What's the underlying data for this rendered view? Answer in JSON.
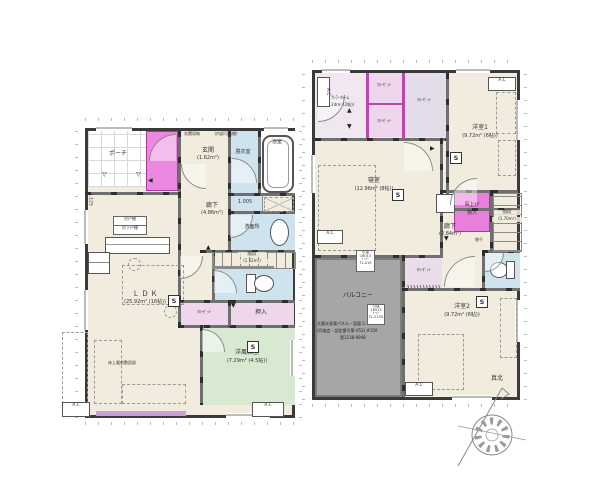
{
  "meta": {
    "type": "house-floor-plan",
    "floors": 2
  },
  "glyphs": {
    "tri_up": "▲",
    "tri_down": "▼",
    "tri_open": "▽",
    "tri_left": "◀",
    "tri_right": "▶"
  },
  "marks": {
    "smoke_detector": "S",
    "ac_unit": "A.C"
  },
  "colors": {
    "wet": "#cfe3ef",
    "tatami": "#d8e9d2",
    "pink": "#eed7ec",
    "magenta": "#ec87df",
    "balcony": "#a6a6a6",
    "lavender": "#e4dcea",
    "floor": "#f1ecdd",
    "deck": "#c9a0d8"
  },
  "floor1": {
    "porch": "ポーチ",
    "entrance_name": "玄関",
    "entrance_area": "(1.62m²)",
    "entrance_storage": "玄関収納",
    "entrance_storage_note": "(内部可動棚)",
    "bath": "浴室",
    "dressing": "脱衣室",
    "washroom": "洗面所",
    "dim_washroom": "1.005",
    "dim_left": "1.125",
    "hall_name": "廊下",
    "hall_area": "(4.86m²)",
    "stairs_name": "階段",
    "stairs_area": "(1.62m²)",
    "closet": "ｸﾛｰｾﾞｯﾄ",
    "oshiire": "押入",
    "washitsu_name": "洋風和室",
    "washitsu_area": "(7.29m² (4.5帖))",
    "ldk_name": "ＬＤＫ",
    "ldk_area": "(25.92m² (16帖))",
    "kitchen_length": "L=2550",
    "cupboard_tag_1": "吊戸棚",
    "cupboard_tag_2": "吊下戸棚",
    "floor_note": "床上暖房敷設部"
  },
  "floor2": {
    "telework_name": "ﾃﾚﾜｰｸﾙｰﾑ",
    "telework_area": "(3.24m² (2帖))",
    "closet": "ｸﾛｰｾﾞｯﾄ",
    "room1_name": "洋室1",
    "room1_area": "(9.72m² (6帖))",
    "bedroom_name": "寝室",
    "bedroom_area": "(12.96m² (8帖))",
    "hall_name": "廊下",
    "hall_area": "(2.84m²)",
    "stairs_name": "階段",
    "stairs_area": "(1.70m²)",
    "liftup_storage_1": "吊上げ",
    "liftup_storage_2": "物入",
    "monohoshi": "物干",
    "balcony": "バルコニー",
    "room2_name": "洋室2",
    "room2_area": "(9.72m² (6帖))",
    "solar_note_1": "太陽光発電パネル・容量 5.10kW",
    "solar_note_2": "(同協会・認定番号第-052) #150",
    "solar_note_3": "第1238-0948",
    "sash_tag_a": [
      "引違",
      "16013",
      "ﾄｰﾒｰ",
      "TL-015"
    ],
    "sash_tag_b": [
      "引違",
      "16513",
      "ﾄｰﾒｰ",
      "TL-2130"
    ]
  },
  "compass": {
    "label": "真北"
  }
}
